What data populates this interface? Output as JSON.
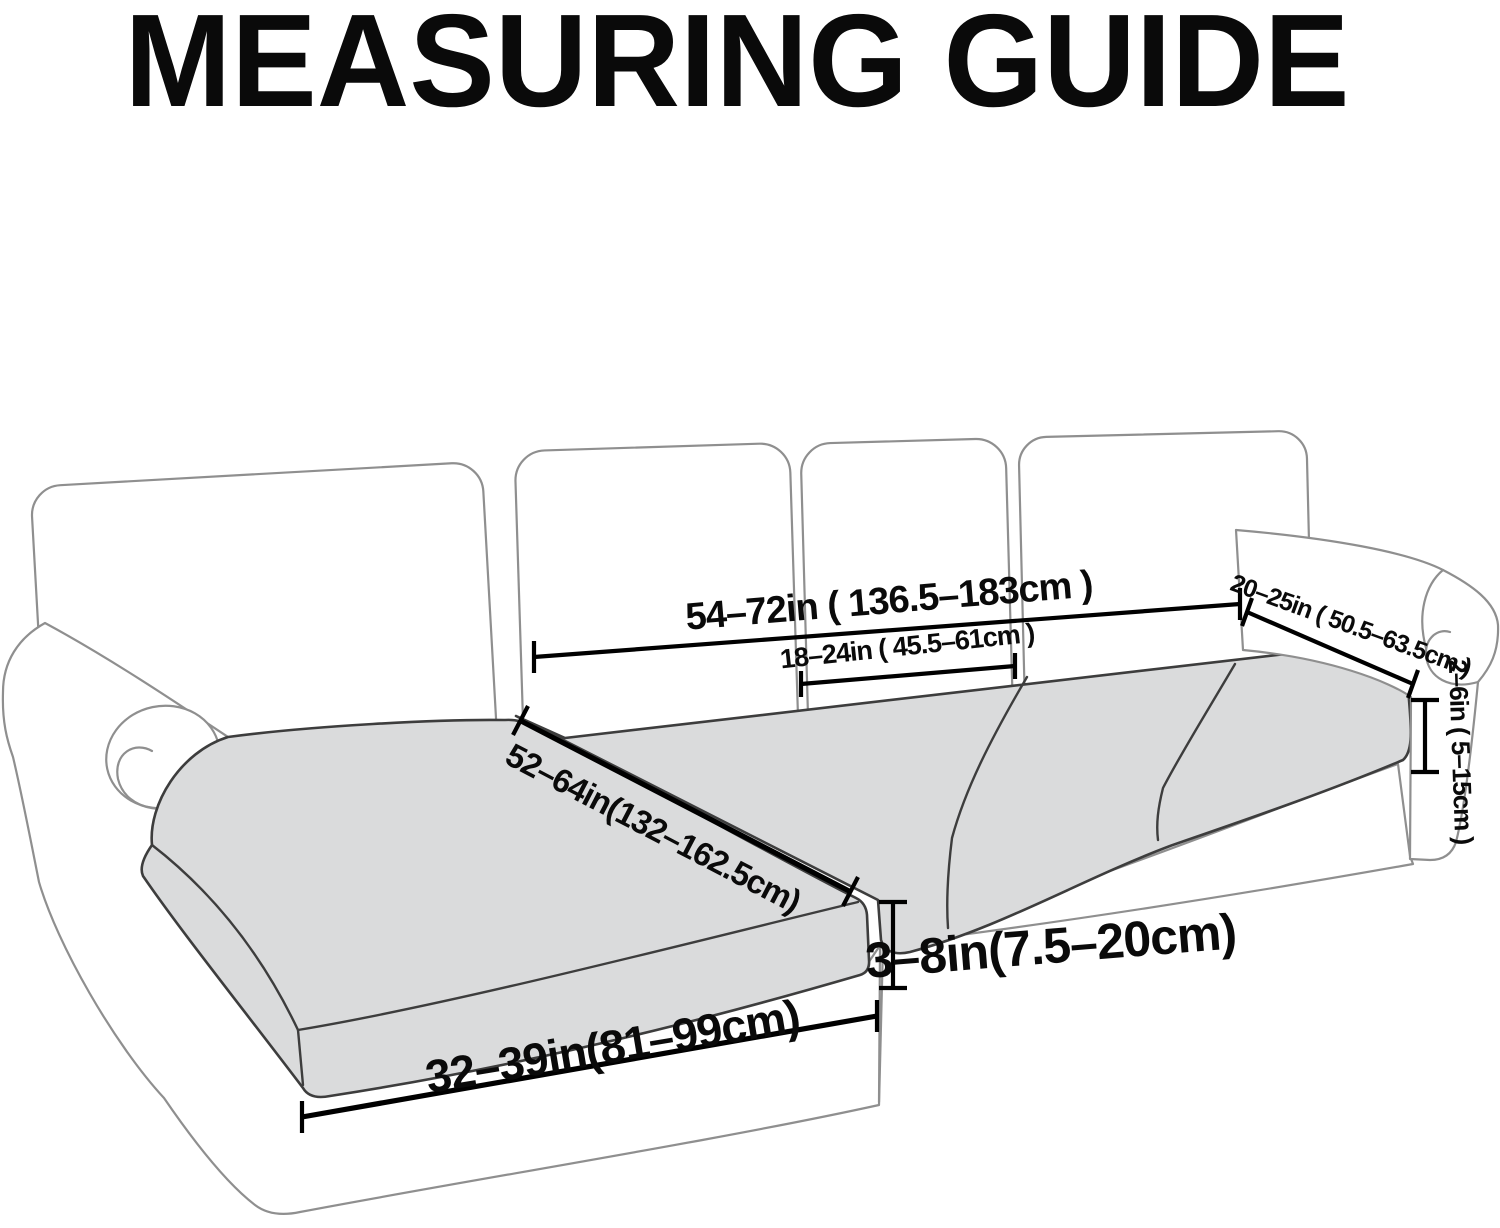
{
  "title": "MEASURING GUIDE",
  "colors": {
    "background": "#ffffff",
    "ink": "#0a0a0a",
    "frame_outline": "#8f8f8f",
    "cushion_fill": "#dadbdc",
    "cushion_outline": "#3d3d3d",
    "annotation": "#000000"
  },
  "diagram": {
    "subject": "sectional-sofa-seat-cushion-measuring-guide",
    "sofa_parts": {
      "back_cushions": 4,
      "seat_cushions": 3,
      "chaise_cushions": 1,
      "arms": 2
    },
    "measurements": [
      {
        "id": "back-width-total",
        "label": "54–72in ( 136.5–183cm )"
      },
      {
        "id": "back-cushion-width",
        "label": "18–24in ( 45.5–61cm )"
      },
      {
        "id": "arm-top-length",
        "label": "20–25in ( 50.5–63.5cm )"
      },
      {
        "id": "seat-side-height",
        "label": "2–6in ( 5–15cm )"
      },
      {
        "id": "chaise-cushion-length",
        "label": "52–64in(132–162.5cm)"
      },
      {
        "id": "cushion-thickness",
        "label": "3–8in(7.5–20cm)"
      },
      {
        "id": "chaise-cushion-width",
        "label": "32–39in(81–99cm)"
      }
    ]
  }
}
